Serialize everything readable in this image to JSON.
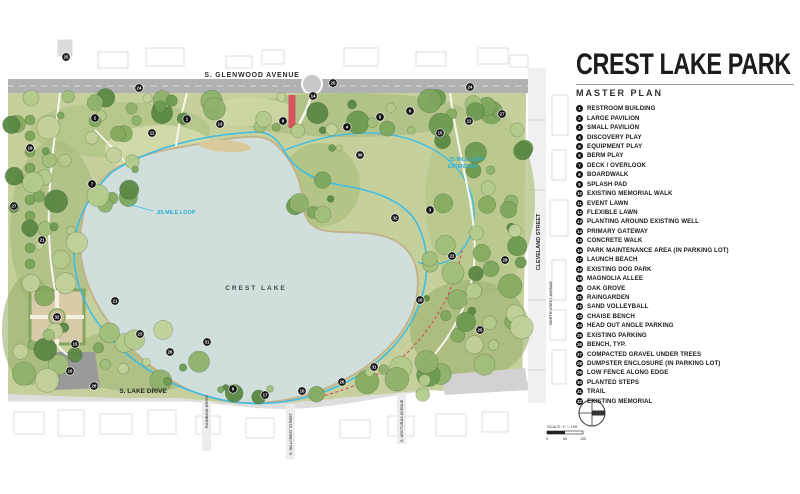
{
  "title": "CREST LAKE PARK",
  "subtitle": "MASTER PLAN",
  "legend": [
    {
      "n": "1",
      "label": "RESTROOM BUILDING"
    },
    {
      "n": "2",
      "label": "LARGE PAVILION"
    },
    {
      "n": "3",
      "label": "SMALL PAVILION"
    },
    {
      "n": "4",
      "label": "DISCOVERY PLAY"
    },
    {
      "n": "5",
      "label": "EQUIPMENT PLAY"
    },
    {
      "n": "6",
      "label": "BERM PLAY"
    },
    {
      "n": "7",
      "label": "DECK / OVERLOOK"
    },
    {
      "n": "8",
      "label": "BOARDWALK"
    },
    {
      "n": "9",
      "label": "SPLASH PAD"
    },
    {
      "n": "10",
      "label": "EXISTING MEMORIAL WALK"
    },
    {
      "n": "11",
      "label": "EVENT LAWN"
    },
    {
      "n": "12",
      "label": "FLEXIBLE LAWN"
    },
    {
      "n": "13",
      "label": "PLANTING AROUND EXISTING WELL"
    },
    {
      "n": "14",
      "label": "PRIMARY GATEWAY"
    },
    {
      "n": "15",
      "label": "CONCRETE WALK"
    },
    {
      "n": "16",
      "label": "PARK MAINTENANCE AREA (IN PARKING LOT)"
    },
    {
      "n": "17",
      "label": "LAUNCH BEACH"
    },
    {
      "n": "18",
      "label": "EXISTING DOG PARK"
    },
    {
      "n": "19",
      "label": "MAGNOLIA ALLEE"
    },
    {
      "n": "20",
      "label": "OAK GROVE"
    },
    {
      "n": "21",
      "label": "RAINGARDEN"
    },
    {
      "n": "22",
      "label": "SAND VOLLEYBALL"
    },
    {
      "n": "23",
      "label": "CHAISE BENCH"
    },
    {
      "n": "24",
      "label": "HEAD OUT ANGLE PARKING"
    },
    {
      "n": "25",
      "label": "EXISTING PARKING"
    },
    {
      "n": "26",
      "label": "BENCH, TYP."
    },
    {
      "n": "27",
      "label": "COMPACTED GRAVEL UNDER TREES"
    },
    {
      "n": "28",
      "label": "DUMPSTER ENCLOSURE (IN PARKING LOT)"
    },
    {
      "n": "29",
      "label": "LOW FENCE ALONG EDGE"
    },
    {
      "n": "30",
      "label": "PLANTED STEPS"
    },
    {
      "n": "31",
      "label": "TRAIL"
    },
    {
      "n": "32",
      "label": "EXISTING MEMORIAL"
    }
  ],
  "map": {
    "streets": {
      "top": "S. GLENWOOD AVENUE",
      "right": "CLEVELAND STREET",
      "far_right": "NORTH CREST AVENUE",
      "bottom": "S. LAKE DRIVE",
      "cross_1": "RAINBOW DRIVE",
      "cross_2": "S. HILLCREST STREET",
      "cross_3": "S. ARCTURAS AVENUE"
    },
    "lake_label": "CREST LAKE",
    "loop_labels": {
      "main": ".85 MILE LOOP",
      "extension_line1": ".25 MILE LOOP",
      "extension_line2": "EXTENSION"
    },
    "markers": [
      {
        "x": 66,
        "y": 57,
        "n": "25"
      },
      {
        "x": 139,
        "y": 88,
        "n": "24"
      },
      {
        "x": 333,
        "y": 83,
        "n": "25"
      },
      {
        "x": 470,
        "y": 87,
        "n": "24"
      },
      {
        "x": 95,
        "y": 118,
        "n": "2"
      },
      {
        "x": 152,
        "y": 133,
        "n": "11"
      },
      {
        "x": 187,
        "y": 119,
        "n": "1"
      },
      {
        "x": 220,
        "y": 124,
        "n": "13"
      },
      {
        "x": 283,
        "y": 121,
        "n": "9"
      },
      {
        "x": 313,
        "y": 96,
        "n": "14"
      },
      {
        "x": 347,
        "y": 127,
        "n": "4"
      },
      {
        "x": 380,
        "y": 117,
        "n": "5"
      },
      {
        "x": 410,
        "y": 111,
        "n": "6"
      },
      {
        "x": 440,
        "y": 133,
        "n": "15"
      },
      {
        "x": 469,
        "y": 121,
        "n": "12"
      },
      {
        "x": 502,
        "y": 114,
        "n": "27"
      },
      {
        "x": 30,
        "y": 148,
        "n": "19"
      },
      {
        "x": 14,
        "y": 206,
        "n": "27"
      },
      {
        "x": 42,
        "y": 240,
        "n": "21"
      },
      {
        "x": 92,
        "y": 184,
        "n": "7"
      },
      {
        "x": 57,
        "y": 317,
        "n": "32"
      },
      {
        "x": 115,
        "y": 301,
        "n": "21"
      },
      {
        "x": 75,
        "y": 344,
        "n": "15"
      },
      {
        "x": 70,
        "y": 371,
        "n": "16"
      },
      {
        "x": 94,
        "y": 386,
        "n": "28"
      },
      {
        "x": 140,
        "y": 334,
        "n": "23"
      },
      {
        "x": 170,
        "y": 352,
        "n": "26"
      },
      {
        "x": 207,
        "y": 342,
        "n": "31"
      },
      {
        "x": 233,
        "y": 389,
        "n": "8"
      },
      {
        "x": 265,
        "y": 395,
        "n": "17"
      },
      {
        "x": 302,
        "y": 391,
        "n": "10"
      },
      {
        "x": 342,
        "y": 382,
        "n": "26"
      },
      {
        "x": 374,
        "y": 367,
        "n": "31"
      },
      {
        "x": 420,
        "y": 300,
        "n": "18"
      },
      {
        "x": 452,
        "y": 256,
        "n": "22"
      },
      {
        "x": 480,
        "y": 330,
        "n": "25"
      },
      {
        "x": 430,
        "y": 210,
        "n": "3"
      },
      {
        "x": 395,
        "y": 218,
        "n": "32"
      },
      {
        "x": 360,
        "y": 155,
        "n": "30"
      },
      {
        "x": 505,
        "y": 260,
        "n": "29"
      }
    ],
    "colors": {
      "park_base": "#c6d09d",
      "lake": "#d0dfdc",
      "shoreline": "#c3b18a",
      "road": "#b0b1b3",
      "trail_cyan": "#3fbde4",
      "memorial_red": "#d4555e",
      "marker_black": "#141414"
    }
  },
  "scale": {
    "text": "SCALE: 1\" = 100'",
    "ticks": [
      "0",
      "50",
      "100"
    ]
  }
}
